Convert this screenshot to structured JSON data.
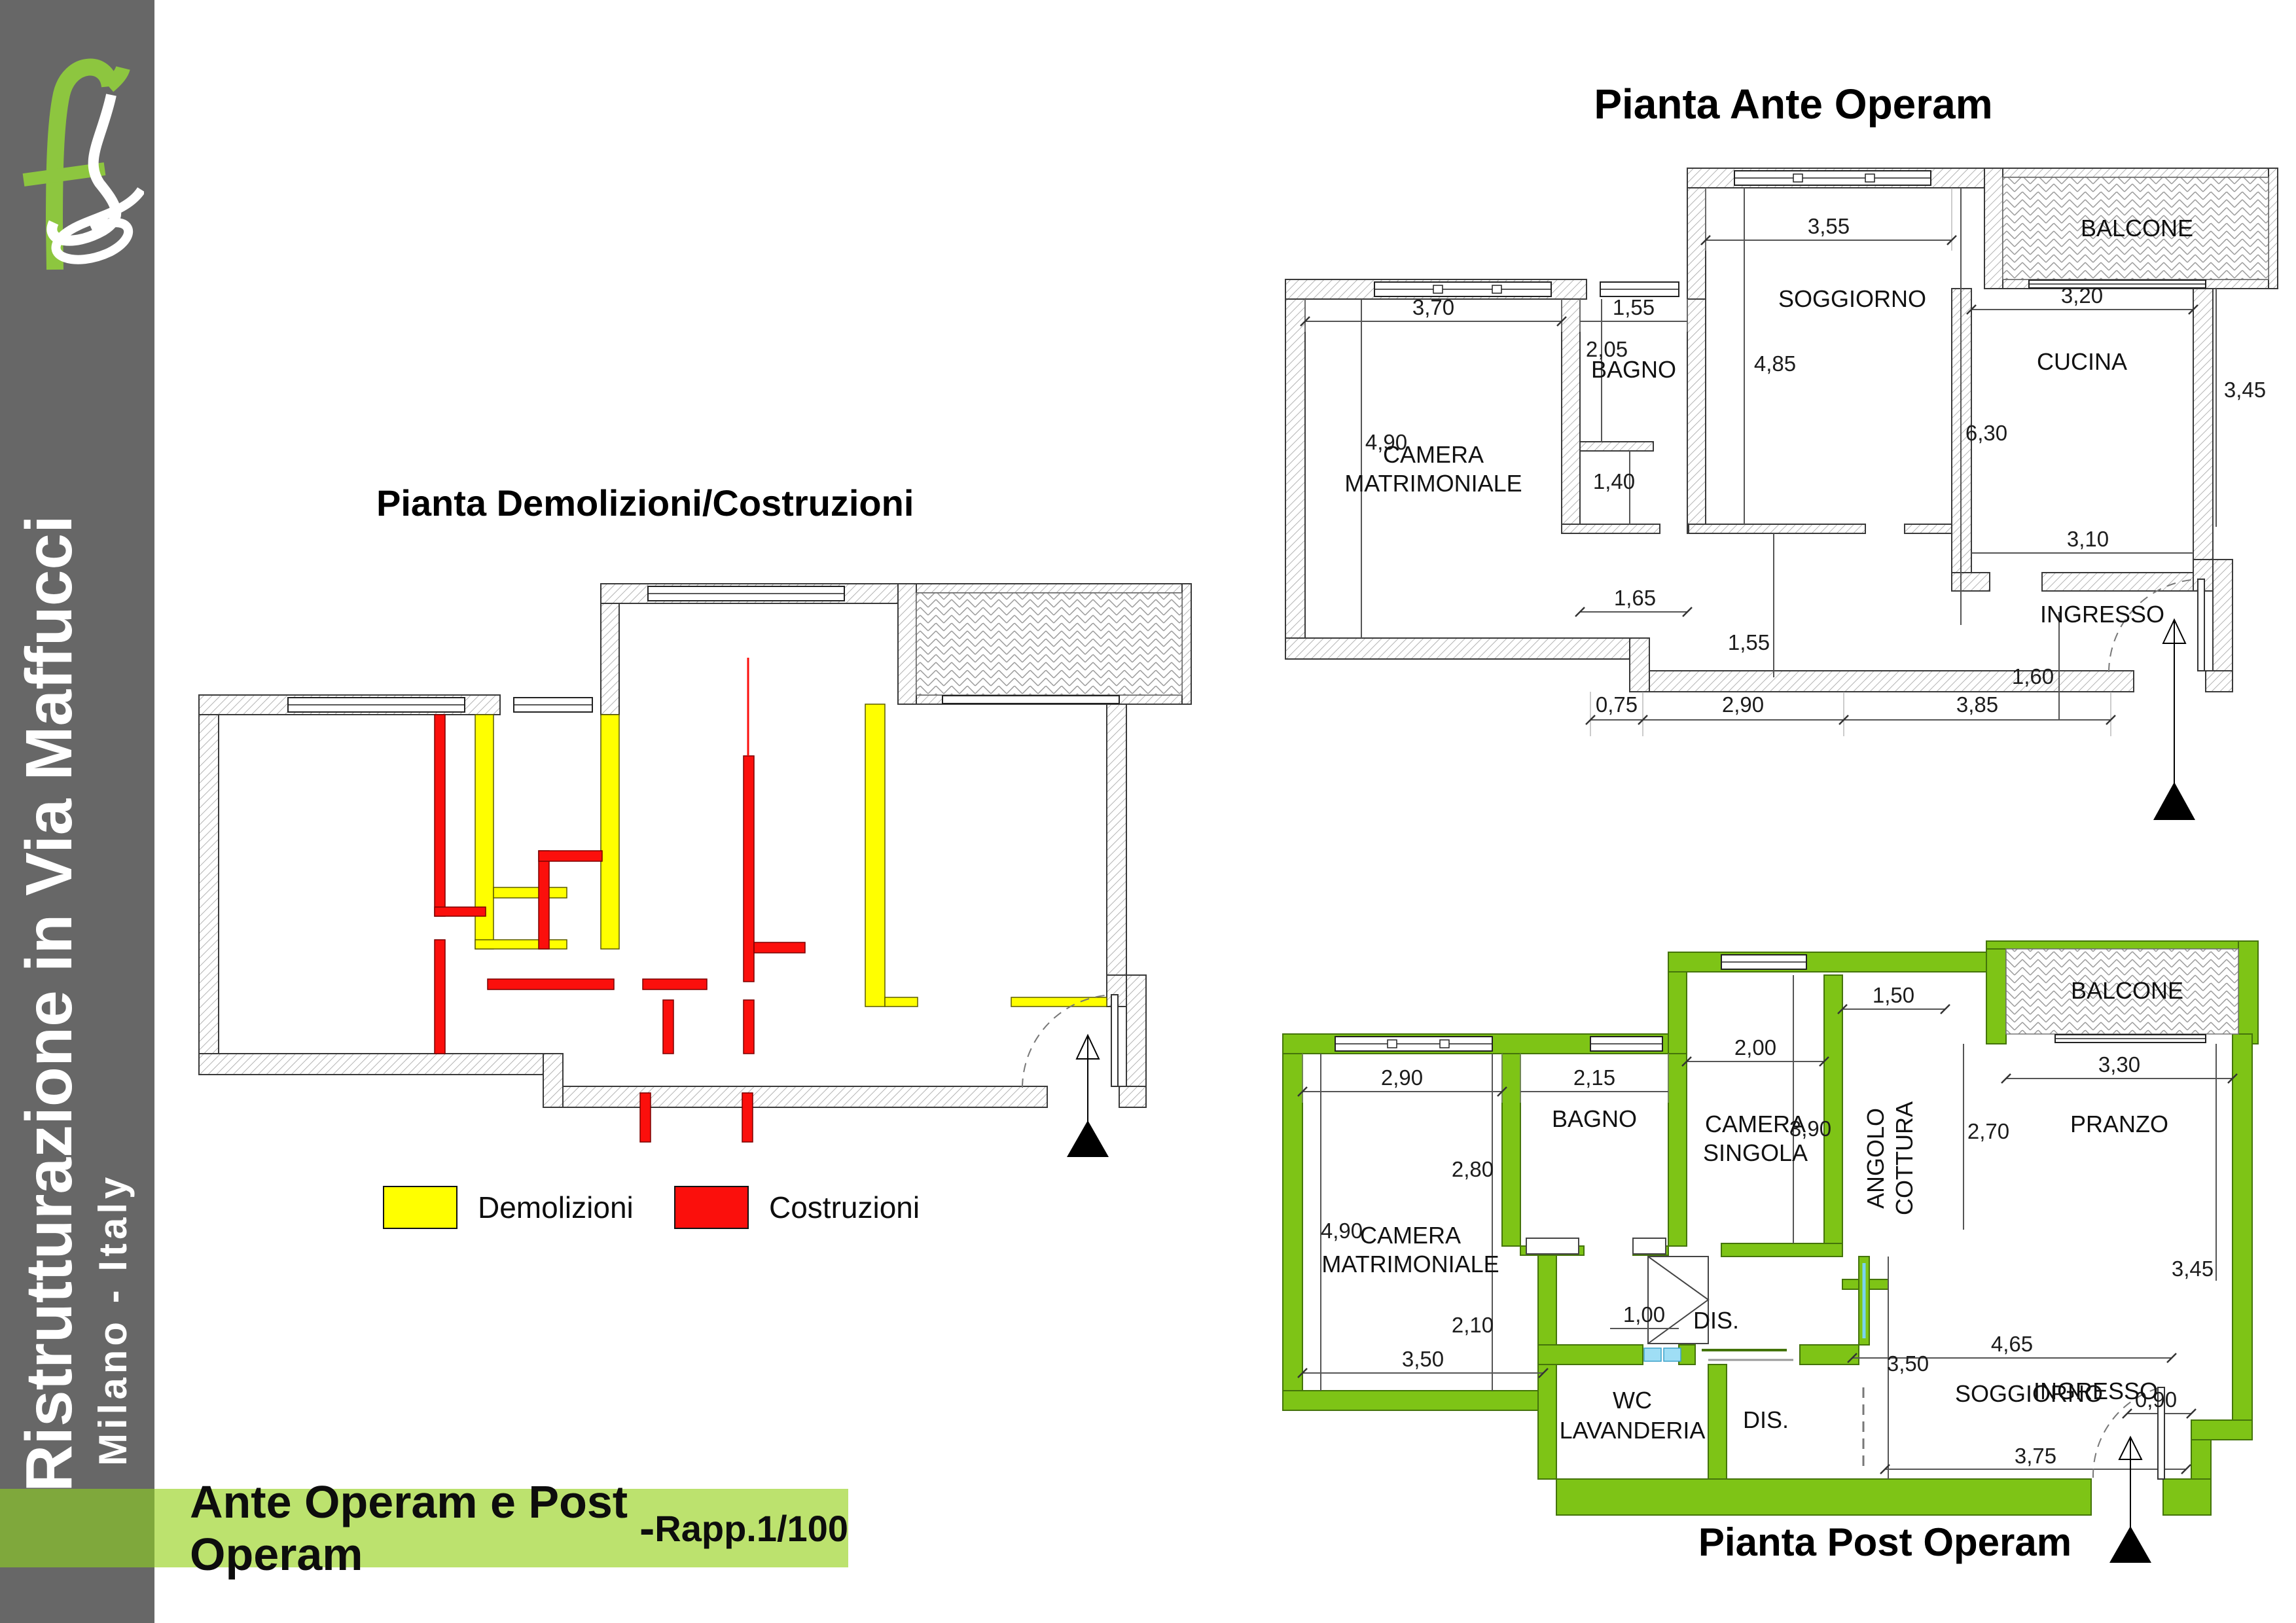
{
  "sidebar": {
    "title": "Ristrutturazione in Via Maffucci",
    "subtitle": "Milano - Italy"
  },
  "banner": {
    "main": "Ante Operam e Post Operam",
    "sep": " - ",
    "scale": "Rapp.1/100"
  },
  "titles": {
    "ante": "Pianta Ante Operam",
    "demo": "Pianta Demolizioni/Costruzioni",
    "post": "Pianta Post Operam"
  },
  "legend": {
    "demolizioni": "Demolizioni",
    "costruzioni": "Costruzioni"
  },
  "colors": {
    "sidebar_gray": "#676767",
    "logo_green": "#8dc63f",
    "wall_green": "#7ec416",
    "banner_light": "#bce26e",
    "banner_dark": "#7fa83c",
    "demolition_yellow": "#ffff00",
    "construction_red": "#fb0f0c"
  },
  "ante": {
    "rooms": {
      "camera1": "CAMERA",
      "camera2": "MATRIMONIALE",
      "bagno": "BAGNO",
      "soggiorno": "SOGGIORNO",
      "cucina": "CUCINA",
      "balcone": "BALCONE",
      "ingresso": "INGRESSO"
    },
    "dims": {
      "d370": "3,70",
      "d155_bagno": "1,55",
      "d205": "2,05",
      "d485": "4,85",
      "d355": "3,55",
      "d320": "3,20",
      "d345": "3,45",
      "d630": "6,30",
      "d310": "3,10",
      "d490": "4,90",
      "d140": "1,40",
      "d165": "1,65",
      "d155_corr": "1,55",
      "d160": "1,60",
      "d075": "0,75",
      "d290": "2,90",
      "d385": "3,85"
    }
  },
  "post": {
    "rooms": {
      "camera1": "CAMERA",
      "camera2": "MATRIMONIALE",
      "bagno": "BAGNO",
      "singola1": "CAMERA",
      "singola2": "SINGOLA",
      "angolo1": "ANGOLO",
      "angolo2": "COTTURA",
      "balcone": "BALCONE",
      "pranzo": "PRANZO",
      "soggiorno": "SOGGIORNO",
      "wc1": "WC",
      "wc2": "LAVANDERIA",
      "dis1": "DIS.",
      "dis2": "DIS.",
      "ingresso": "INGRESSO"
    },
    "dims": {
      "d290": "2,90",
      "d215": "2,15",
      "d200": "2,00",
      "d150": "1,50",
      "d270": "2,70",
      "d330": "3,30",
      "d390": "3,90",
      "d345": "3,45",
      "d280": "2,80",
      "d210": "2,10",
      "d490": "4,90",
      "d465": "4,65",
      "d090": "0,90",
      "d350v": "3,50",
      "d100": "1,00",
      "d350b": "3,50",
      "d375": "3,75"
    }
  }
}
